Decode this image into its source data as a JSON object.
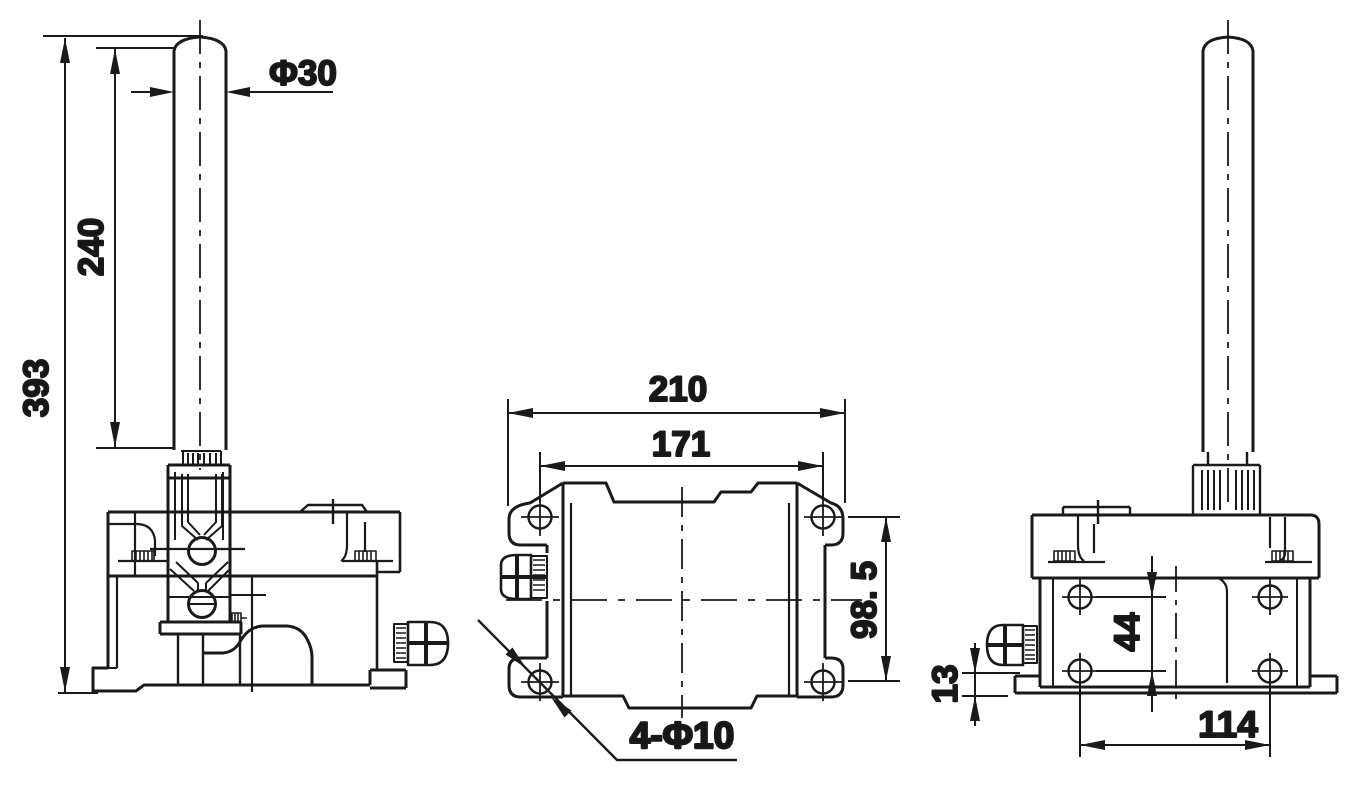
{
  "page": {
    "background": "#ffffff",
    "line_color": "#1a1a1a"
  },
  "dimensions": {
    "front_view": {
      "overall_height": "393",
      "rod_length": "240",
      "rod_diameter": "Φ30"
    },
    "top_view": {
      "overall_width": "210",
      "hole_pitch_width": "171",
      "hole_pitch_depth": "98. 5",
      "mounting_holes": "4-Φ10"
    },
    "side_view": {
      "hole_pitch_vertical": "44",
      "base_thickness": "13",
      "hole_pitch_horizontal": "114"
    }
  }
}
